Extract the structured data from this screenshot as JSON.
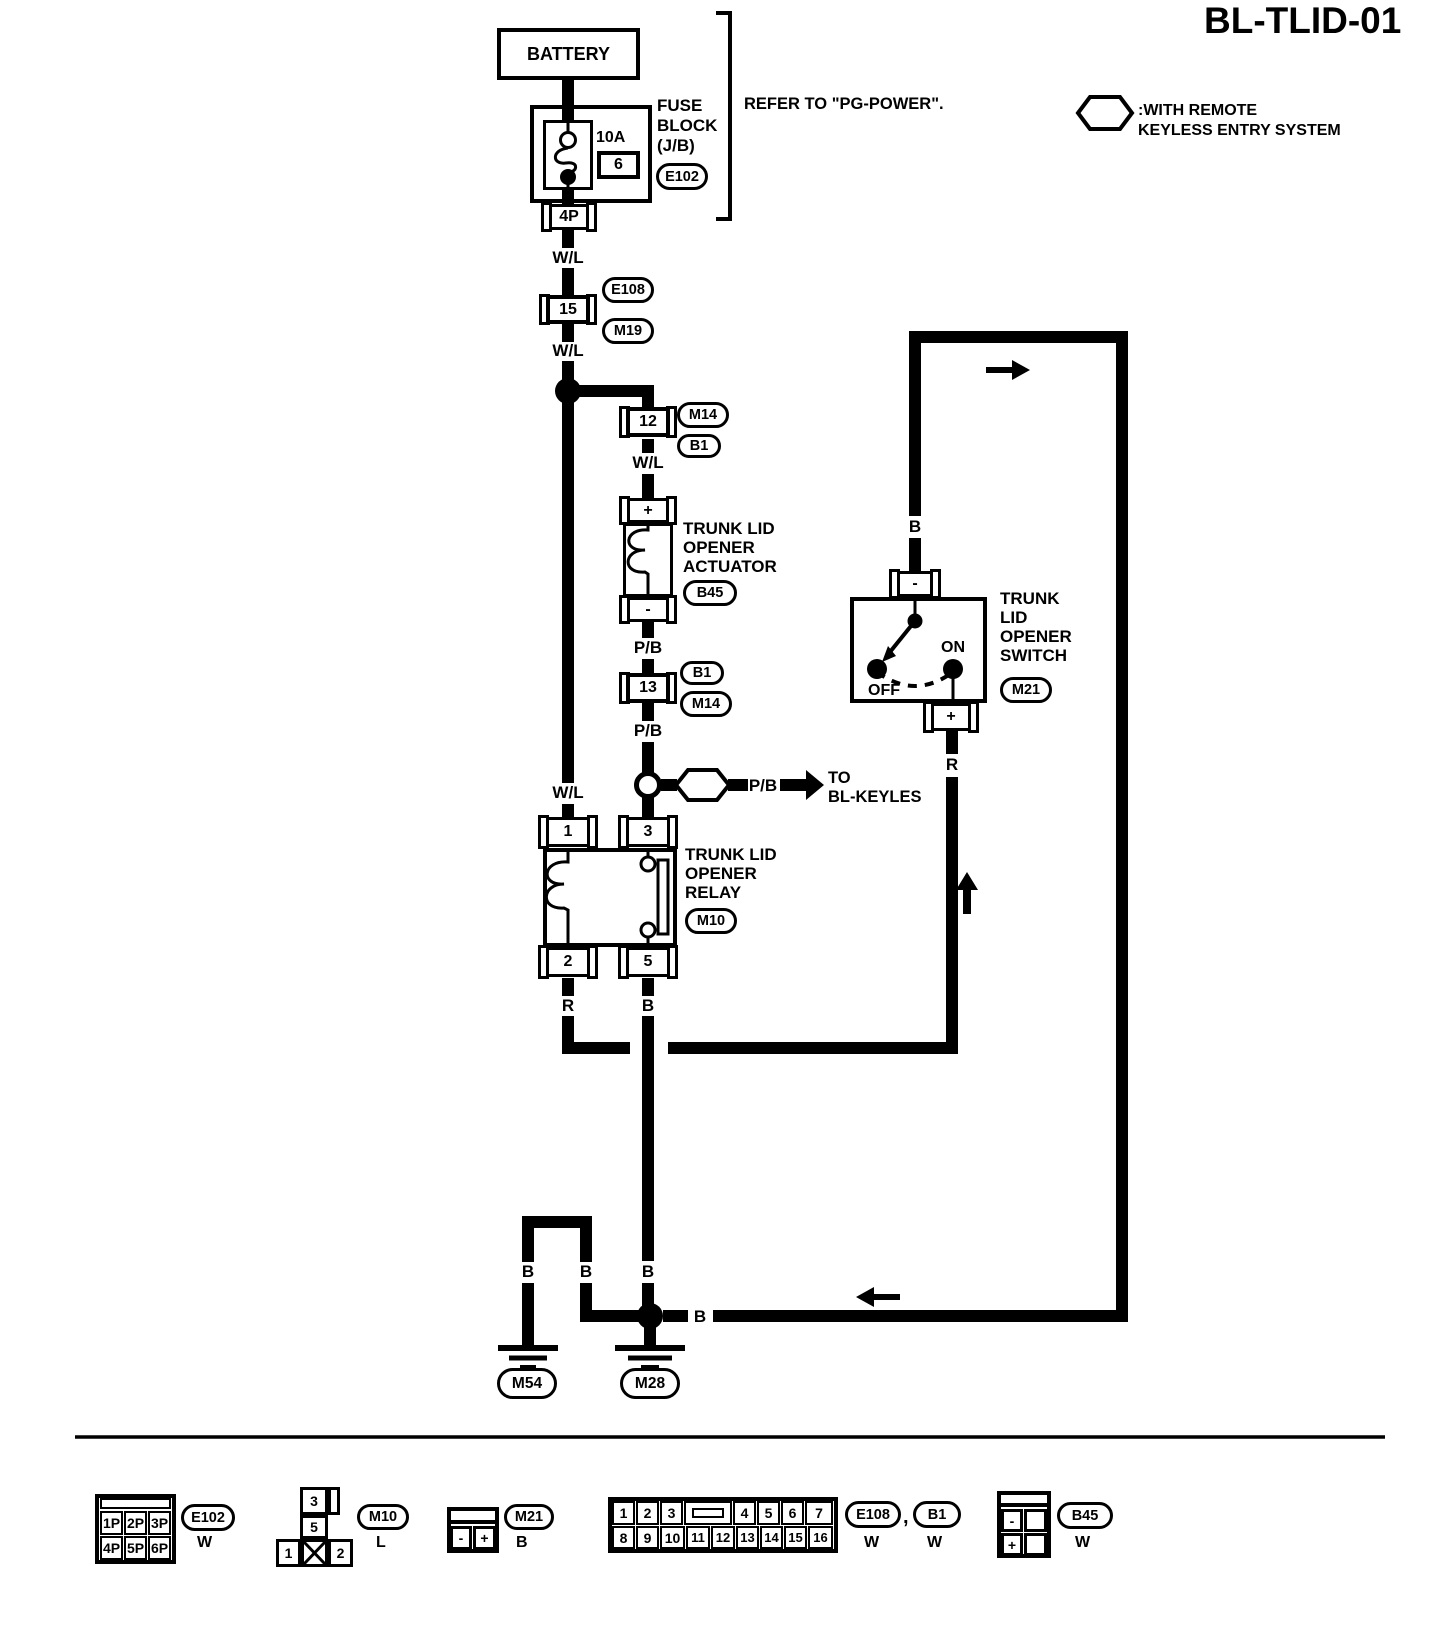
{
  "title": "BL-TLID-01",
  "note": {
    "symbol": "RK",
    "text": ":WITH REMOTE\nKEYLESS ENTRY SYSTEM"
  },
  "refer_note": "REFER TO \"PG-POWER\".",
  "battery": "BATTERY",
  "fuse": {
    "rating": "10A",
    "number": "6",
    "block_label": "FUSE\nBLOCK\n(J/B)",
    "connector": "E102",
    "out_pin": "4P"
  },
  "wires": {
    "wl_top": "W/L",
    "wl_mid": "W/L",
    "wl_branch": "W/L",
    "wl_relay": "W/L",
    "pb_above_13": "P/B",
    "pb_below_13": "P/B",
    "pb_rk": "P/B",
    "r_pin2": "R",
    "b_pin5": "B",
    "b_switch": "B",
    "r_switch": "R",
    "b_u_left": "B",
    "b_u_right": "B",
    "b_main": "B",
    "b_loop": "B"
  },
  "conn15": {
    "pin": "15",
    "oval_top": "E108",
    "oval_bottom": "M19"
  },
  "conn12": {
    "pin": "12",
    "oval_top": "M14",
    "oval_bottom": "B1"
  },
  "conn13": {
    "pin": "13",
    "oval_top": "B1",
    "oval_bottom": "M14"
  },
  "actuator": {
    "plus": "+",
    "minus": "-",
    "name": "TRUNK LID\nOPENER\nACTUATOR",
    "oval": "B45"
  },
  "rk_branch": {
    "symbol": "RK",
    "dest": "TO\nBL-KEYLES"
  },
  "relay": {
    "pin1": "1",
    "pin3": "3",
    "pin2": "2",
    "pin5": "5",
    "name": "TRUNK LID\nOPENER\nRELAY",
    "oval": "M10"
  },
  "switch": {
    "minus": "-",
    "plus": "+",
    "on": "ON",
    "off": "OFF",
    "name": "TRUNK\nLID\nOPENER\nSWITCH",
    "oval": "M21"
  },
  "grounds": {
    "left": "M54",
    "right": "M28"
  },
  "legend": {
    "e102": {
      "cells": [
        "1P",
        "2P",
        "3P",
        "4P",
        "5P",
        "6P"
      ],
      "label": "E102",
      "color": "W"
    },
    "m10": {
      "top": "3",
      "mid": "5",
      "left": "1",
      "right": "2",
      "label": "M10",
      "color": "L"
    },
    "m21": {
      "minus": "-",
      "plus": "+",
      "label": "M21",
      "color": "B"
    },
    "e108b1": {
      "top": [
        "1",
        "2",
        "3",
        "4",
        "5",
        "6",
        "7"
      ],
      "bottom": [
        "8",
        "9",
        "10",
        "11",
        "12",
        "13",
        "14",
        "15",
        "16"
      ],
      "label1": "E108",
      "comma": ",",
      "label2": "B1",
      "color1": "W",
      "color2": "W"
    },
    "b45": {
      "minus": "-",
      "plus": "+",
      "label": "B45",
      "color": "W"
    }
  }
}
